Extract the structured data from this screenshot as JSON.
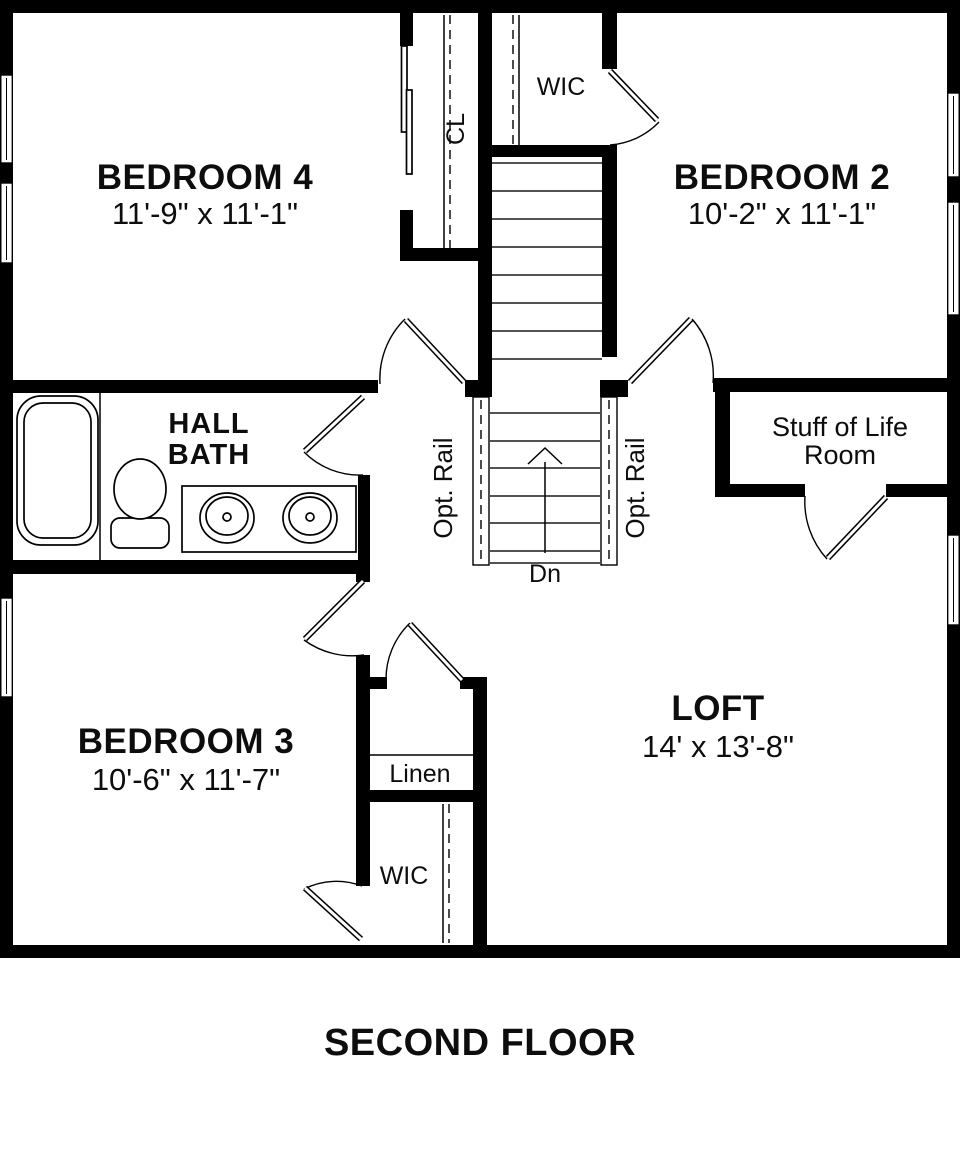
{
  "title": "SECOND FLOOR",
  "rooms": {
    "bedroom4": {
      "name": "BEDROOM 4",
      "dims": "11'-9\" x 11'-1\""
    },
    "bedroom2": {
      "name": "BEDROOM 2",
      "dims": "10'-2\" x 11'-1\""
    },
    "bedroom3": {
      "name": "BEDROOM 3",
      "dims": "10'-6\" x 11'-7\""
    },
    "loft": {
      "name": "LOFT",
      "dims": "14' x 13'-8\""
    },
    "hall_bath": {
      "line1": "HALL",
      "line2": "BATH"
    },
    "stuff_of_life_room": {
      "line1": "Stuff of Life",
      "line2": "Room"
    },
    "wic_top": {
      "name": "WIC"
    },
    "wic_bottom": {
      "name": "WIC"
    },
    "linen": {
      "name": "Linen"
    },
    "closet": {
      "name": "CL"
    }
  },
  "stairs": {
    "down_label": "Dn",
    "opt_rail_left": "Opt. Rail",
    "opt_rail_right": "Opt. Rail"
  },
  "colors": {
    "wall": "#000000",
    "background": "#ffffff"
  }
}
